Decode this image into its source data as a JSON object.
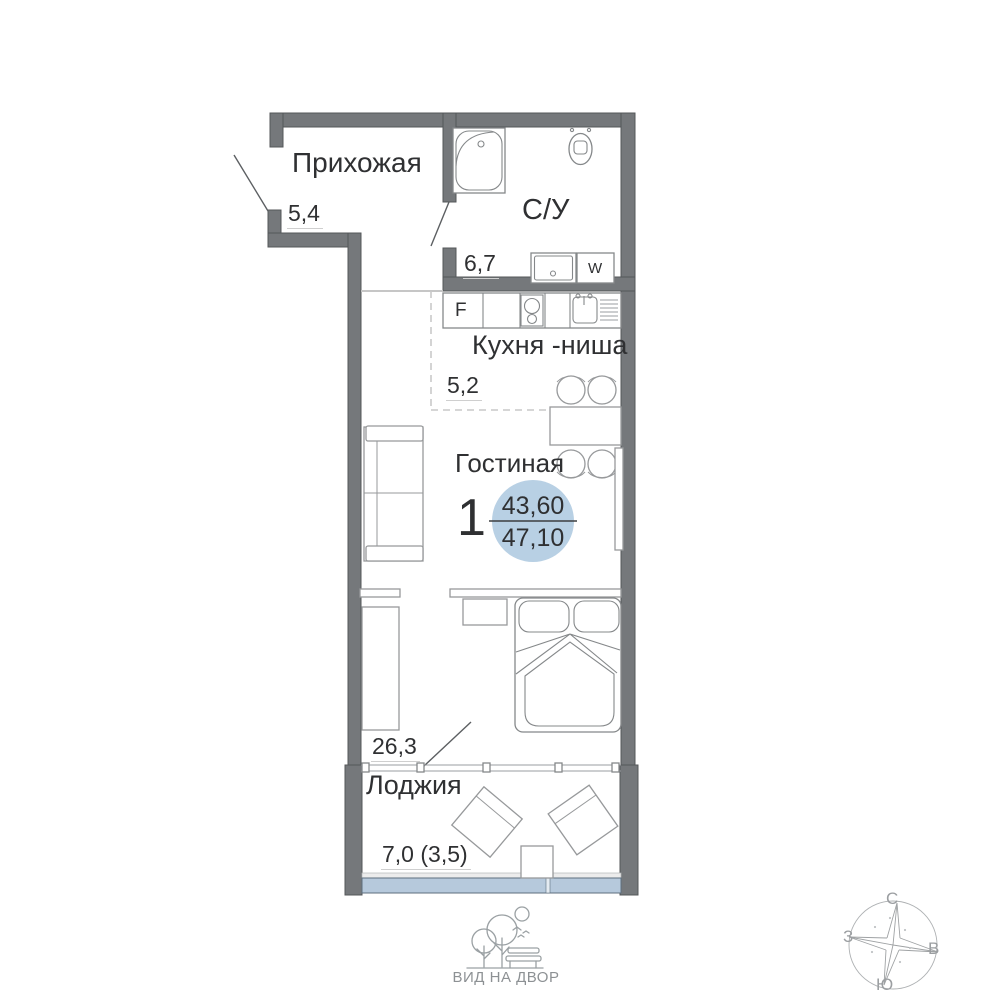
{
  "unit": {
    "number": "1",
    "area_main": "43,60",
    "area_total": "47,10"
  },
  "rooms": {
    "hallway": {
      "name": "Прихожая",
      "area": "5,4"
    },
    "bathroom": {
      "name": "С/У",
      "area": "6,7"
    },
    "kitchen": {
      "name": "Кухня -ниша",
      "area": "5,2"
    },
    "living": {
      "name": "Гостиная",
      "area": "26,3"
    },
    "loggia": {
      "name": "Лоджия",
      "area": "7,0 (3,5)"
    }
  },
  "appliances": {
    "fridge_label": "F",
    "washer_label": "W"
  },
  "compass": {
    "north": "С",
    "south": "Ю",
    "west": "З",
    "east": "В"
  },
  "footer": {
    "courtyard_label": "ВИД НА ДВОР"
  },
  "colors": {
    "wall": "#75787b",
    "badge_fill": "#b8d0e4",
    "glazing_fill": "#b6c9dc",
    "text": "#2f3032"
  }
}
